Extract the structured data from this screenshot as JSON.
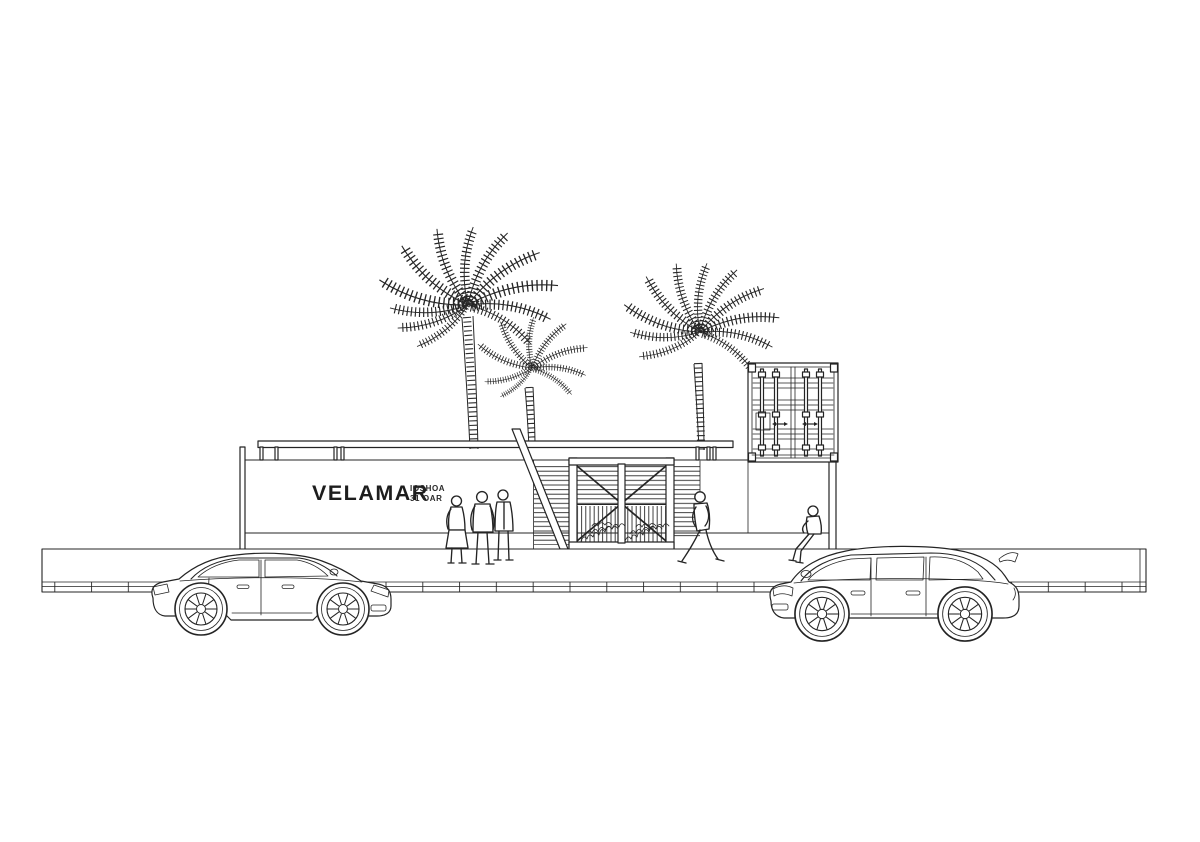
{
  "canvas": {
    "background": "#ffffff",
    "ink": "#242424",
    "width_px": 1200,
    "height_px": 842
  },
  "signage": {
    "name": "VELAMAR",
    "sub_line1": "IOSHOA",
    "sub_line2": "31 OAR"
  },
  "scene_objects": {
    "palm_trees": 3,
    "people": 5,
    "cars": [
      "sedan",
      "suv"
    ],
    "features": [
      "flat-roof-canopy",
      "slatted-entrance-gate",
      "stair-stringer",
      "shipping-container",
      "sidewalk-with-paving-joints"
    ]
  }
}
